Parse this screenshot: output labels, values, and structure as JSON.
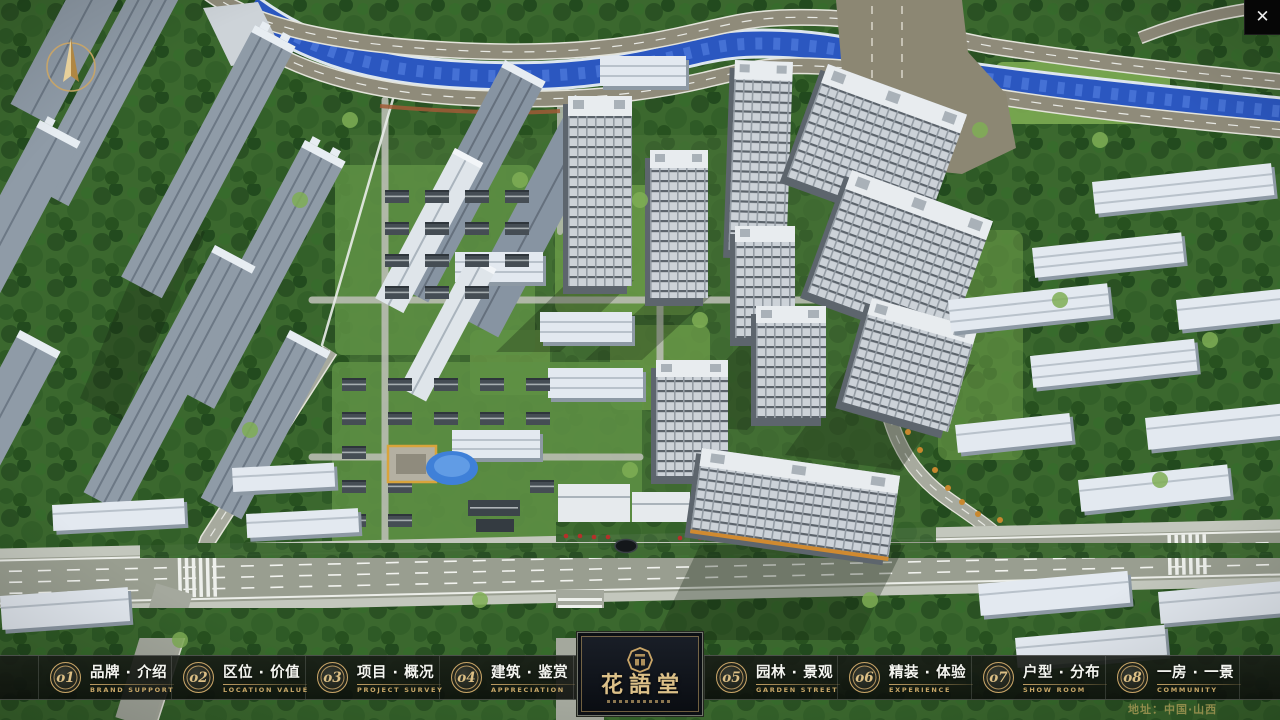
{
  "nav": {
    "items": [
      {
        "num": "o1",
        "zh": "品牌 · 介绍",
        "en": "BRAND SUPPORT"
      },
      {
        "num": "o2",
        "zh": "区位 · 价值",
        "en": "LOCATION VALUE"
      },
      {
        "num": "o3",
        "zh": "项目 · 概况",
        "en": "PROJECT SURVEY"
      },
      {
        "num": "o4",
        "zh": "建筑 · 鉴赏",
        "en": "APPRECIATION"
      },
      {
        "num": "o5",
        "zh": "园林 · 景观",
        "en": "GARDEN STREET"
      },
      {
        "num": "o6",
        "zh": "精装 · 体验",
        "en": "EXPERIENCE"
      },
      {
        "num": "o7",
        "zh": "户型 · 分布",
        "en": "SHOW ROOM"
      },
      {
        "num": "o8",
        "zh": "一房 · 一景",
        "en": "COMMUNITY"
      }
    ]
  },
  "logo": {
    "title": "花語堂"
  },
  "footer": {
    "address": "地址：中国·山西"
  },
  "icons": {
    "close": "✕"
  },
  "colors": {
    "gold": "#c9a567",
    "bar_bg": "#12160f",
    "river": "#2b57c0",
    "grass": "#4a7338"
  }
}
